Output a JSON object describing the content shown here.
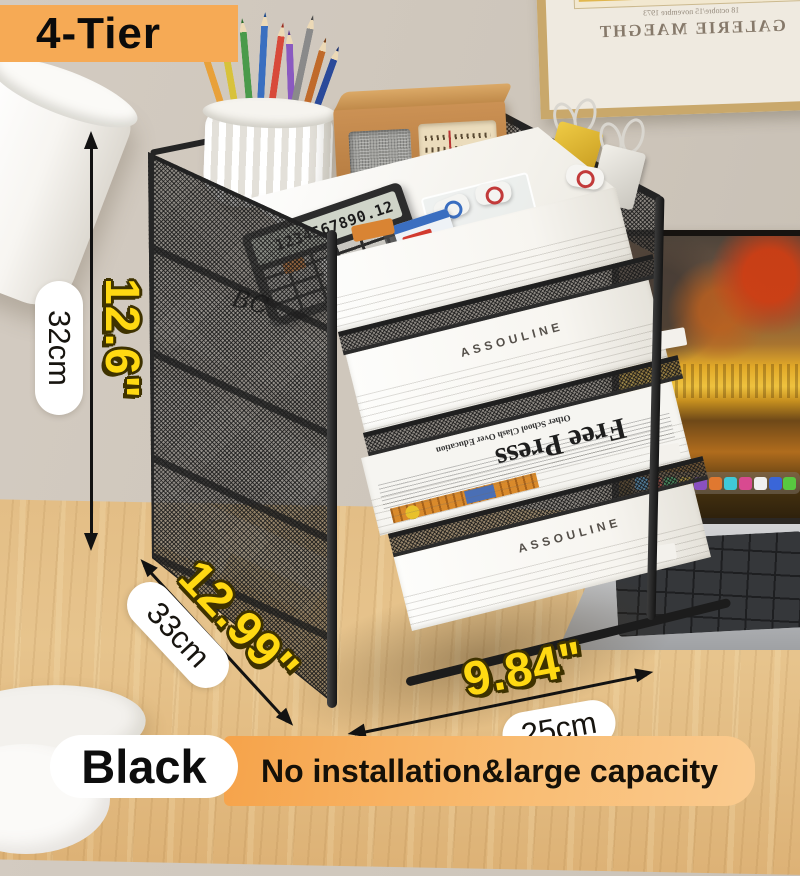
{
  "product": {
    "tier_label": "4-Tier",
    "color_label": "Black",
    "feature_banner": "No installation&large capacity",
    "dimensions": {
      "height_cm": "32cm",
      "height_in": "12.6\"",
      "depth_cm": "33cm",
      "depth_in": "12.99\"",
      "width_cm": "25cm",
      "width_in": "9.84\""
    }
  },
  "scene": {
    "calculator_display": "1234567890.12",
    "book_brand": "ASSOULINE",
    "top_book_brand": "tofucasa",
    "side_scribble": "BC",
    "newspaper": {
      "masthead": "Free Press",
      "headline": "Other School Clash Over Education"
    },
    "frame": {
      "title": "GALERIE MAEGHT",
      "subtitle": "18 octobre/15 novembre 1973"
    }
  },
  "colors": {
    "accent_orange": "#F6AA55",
    "banner_orange": "#F7A94F",
    "dimension_yellow": "#FFD912",
    "desk_wood": "#DFBA82",
    "wall": "#CFC7BD"
  }
}
